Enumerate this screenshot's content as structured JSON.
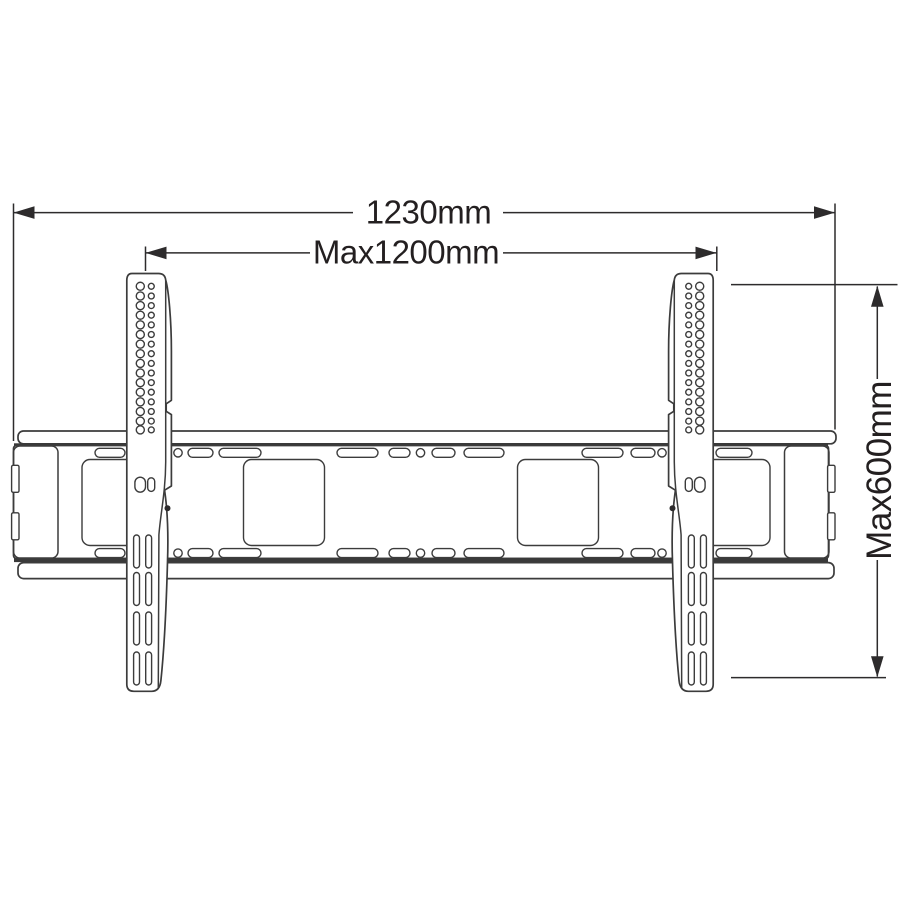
{
  "drawing": {
    "kind": "technical-dimension-drawing",
    "background_color": "#ffffff",
    "line_color": "#2d2b2c",
    "text_color": "#231f20",
    "dimensions": [
      {
        "id": "overall-width",
        "label": "1230mm",
        "orientation": "horizontal"
      },
      {
        "id": "max-mounting-width",
        "label": "Max1200mm",
        "orientation": "horizontal"
      },
      {
        "id": "max-mounting-height",
        "label": "Max600mm",
        "orientation": "vertical"
      }
    ]
  }
}
